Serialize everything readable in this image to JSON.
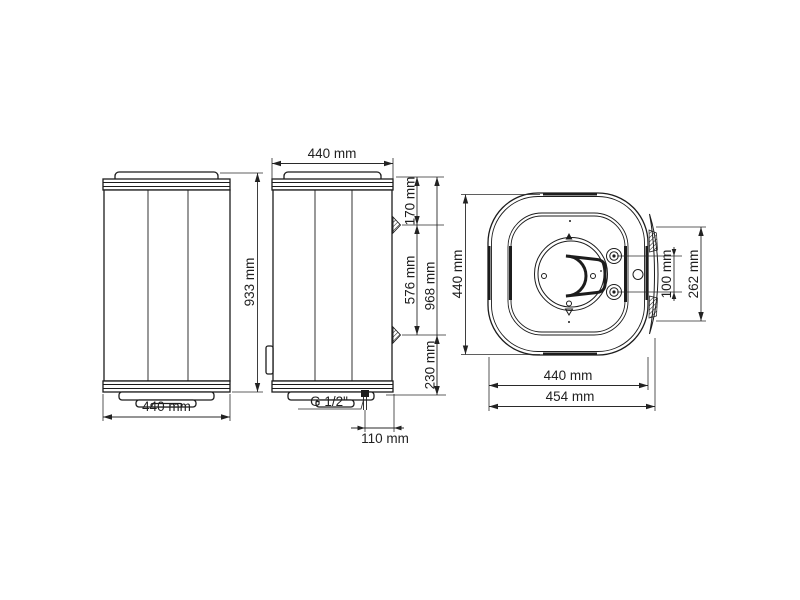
{
  "drawing": {
    "front_view": {
      "height": "933 mm",
      "width": "440 mm"
    },
    "side_view": {
      "width": "440 mm",
      "top_to_bracket": "170 mm",
      "bracket_spacing": "576 mm",
      "overall_height": "968 mm",
      "bracket_to_bottom": "230 mm",
      "connection_thread": "G 1/2\"",
      "connection_offset": "110 mm"
    },
    "top_view": {
      "depth": "440 mm",
      "port_spacing": "100 mm",
      "bracket_span": "262 mm",
      "width": "440 mm",
      "overall_width": "454 mm"
    }
  }
}
